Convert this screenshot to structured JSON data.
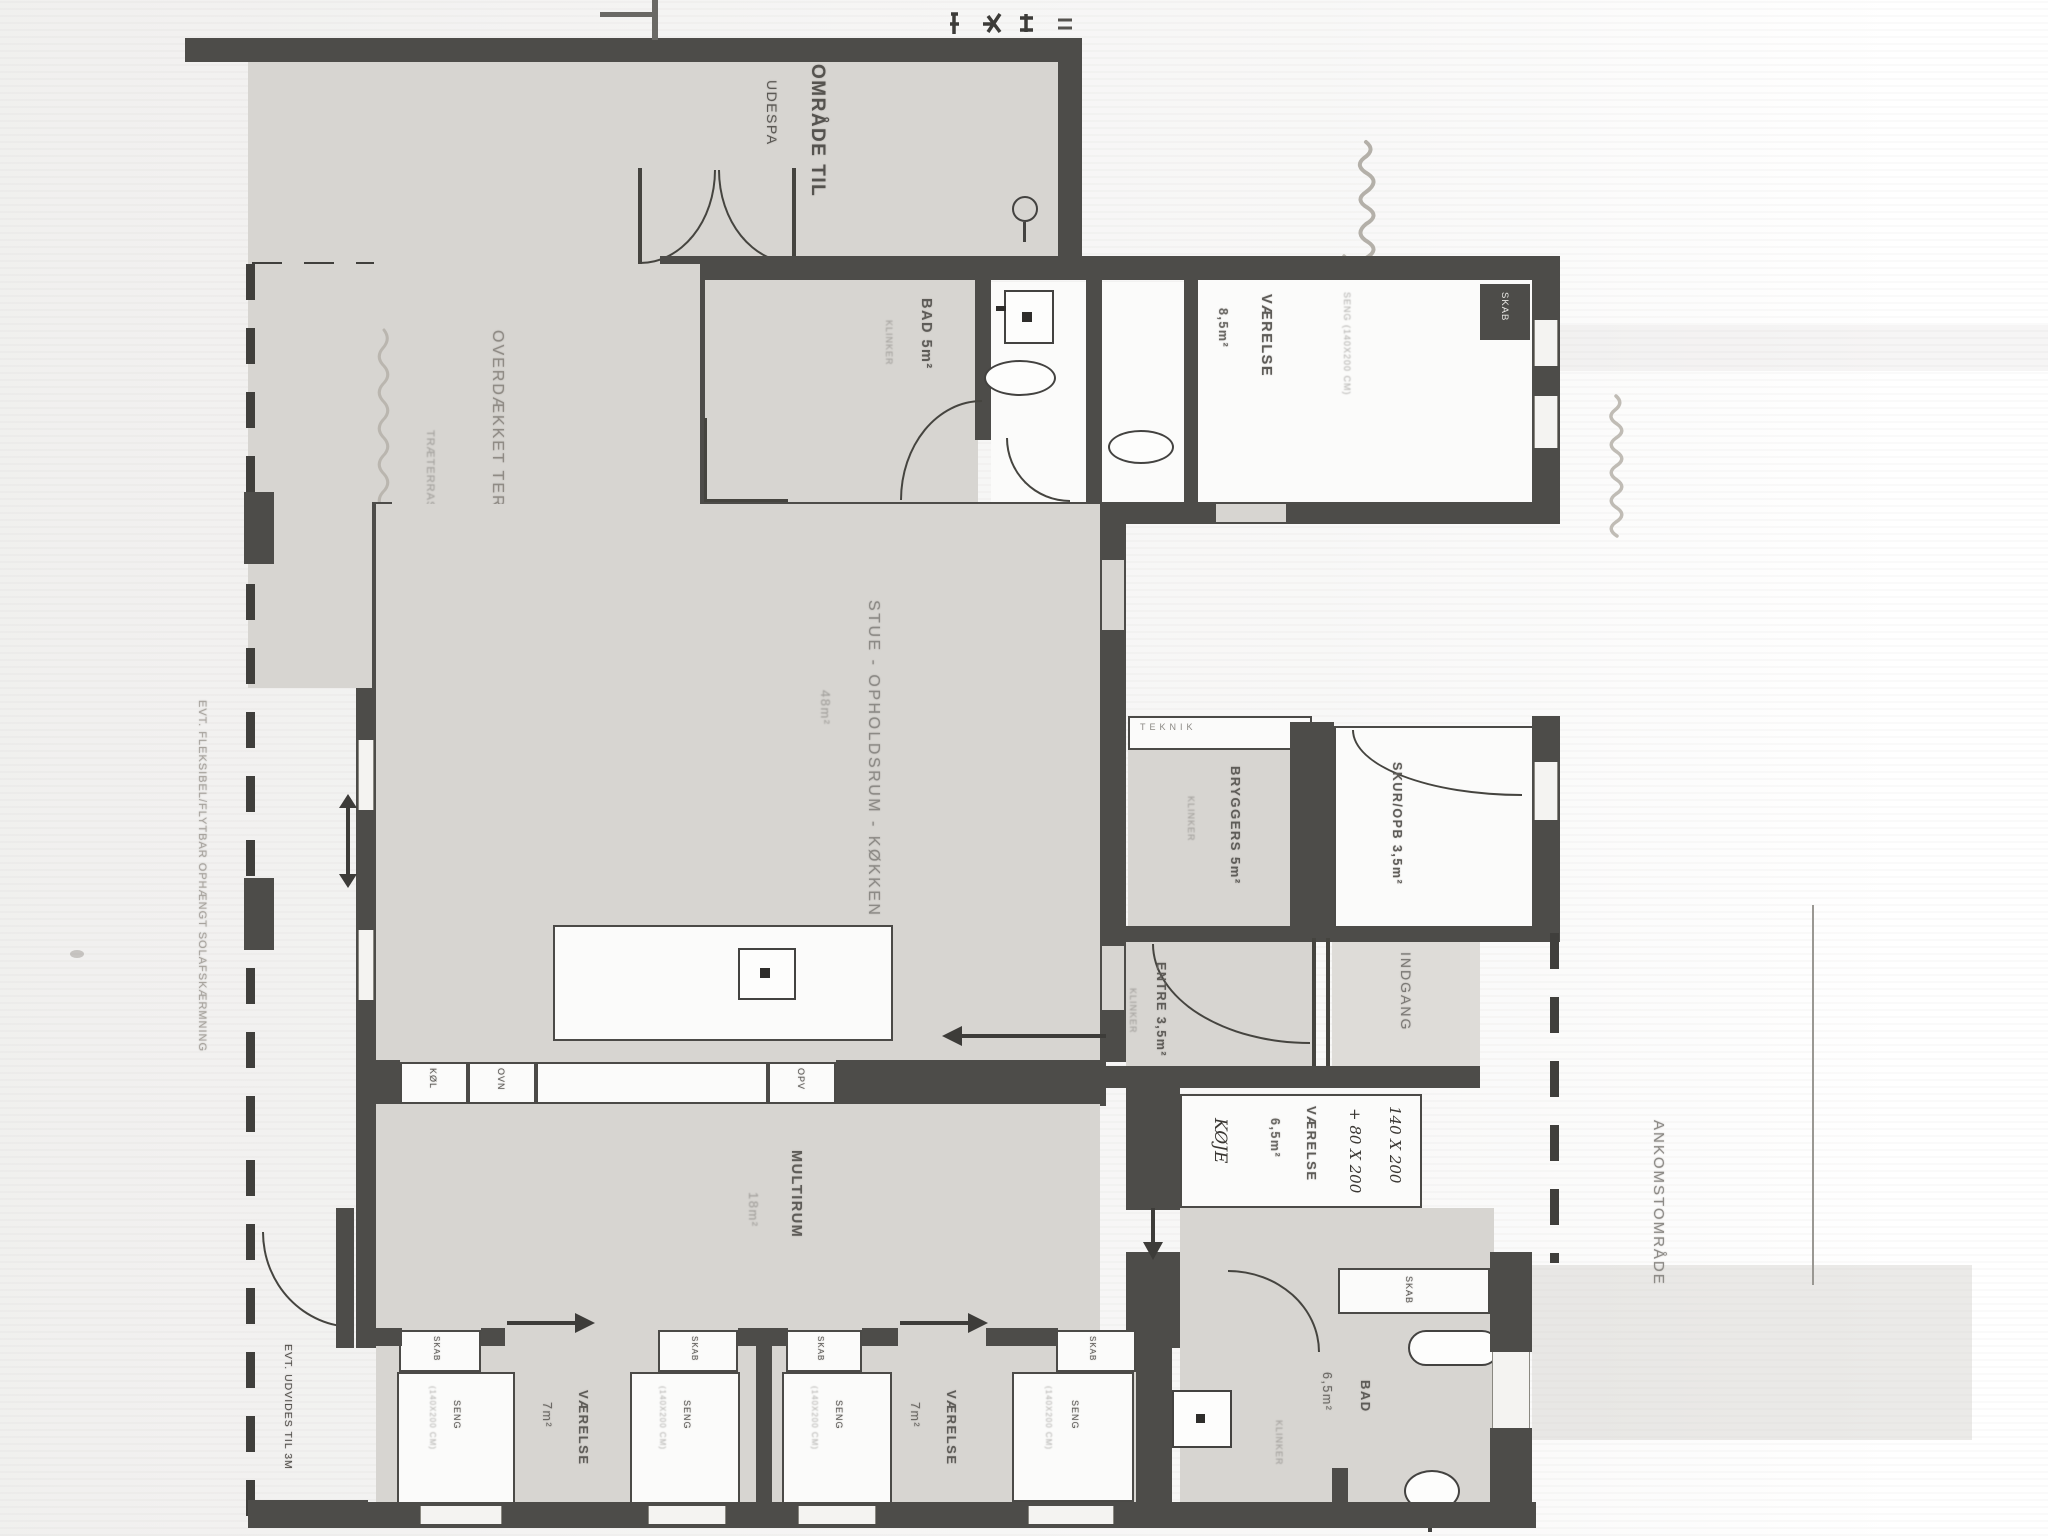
{
  "plan": {
    "spa": {
      "line1": "OMRÅDE TIL",
      "line2": "UDESPA"
    },
    "terrace": {
      "label": "OVERDÆKKET TERRASSE 18m²",
      "deck_note": "TRÆTERRASSE"
    },
    "sun_note": "EVT. FLEKSIBEL/FLYTBAR OPHÆNGT SOLAFSKÆRMNING",
    "expand_note": "EVT. UDVIDES TIL 3M",
    "stue": {
      "name": "STUE - OPHOLDSRUM - KØKKEN",
      "area": "48m²"
    },
    "kitchen": {
      "appl1": "KØL",
      "appl2": "OVN",
      "appl3": "OPV"
    },
    "bad_top": {
      "name": "BAD 5m²",
      "floor_note": "KLINKER"
    },
    "vaerelse85": {
      "name": "VÆRELSE",
      "area": "8,5m²",
      "bed_note": "SENG (140X200 CM)",
      "closet": "SKAB"
    },
    "teknik": "TEKNIK",
    "bryggers": {
      "name": "BRYGGERS 5m²",
      "floor_note": "KLINKER"
    },
    "skur": {
      "name": "SKUR/OPB 3,5m²"
    },
    "entre": {
      "name": "ENTRE 3,5m²",
      "floor_note": "KLINKER"
    },
    "indgang": "INDGANG",
    "multirum": {
      "name": "MULTIRUM",
      "area": "18m²"
    },
    "vaerelse65": {
      "name": "VÆRELSE",
      "area": "6,5m²",
      "hand_note1": "140 X 200",
      "hand_note2": "+ 80 X 200",
      "hand_note3": "KØJE"
    },
    "ankomst": "ANKOMSTOMRÅDE",
    "bedroom7": {
      "name": "VÆRELSE",
      "area": "7m²",
      "bed": "SENG",
      "bed_size": "(140X200 CM)",
      "closet": "SKAB"
    },
    "bad_bottom": {
      "name": "BAD",
      "area": "6,5m²",
      "floor_note": "KLINKER",
      "closet": "SKAB"
    }
  }
}
